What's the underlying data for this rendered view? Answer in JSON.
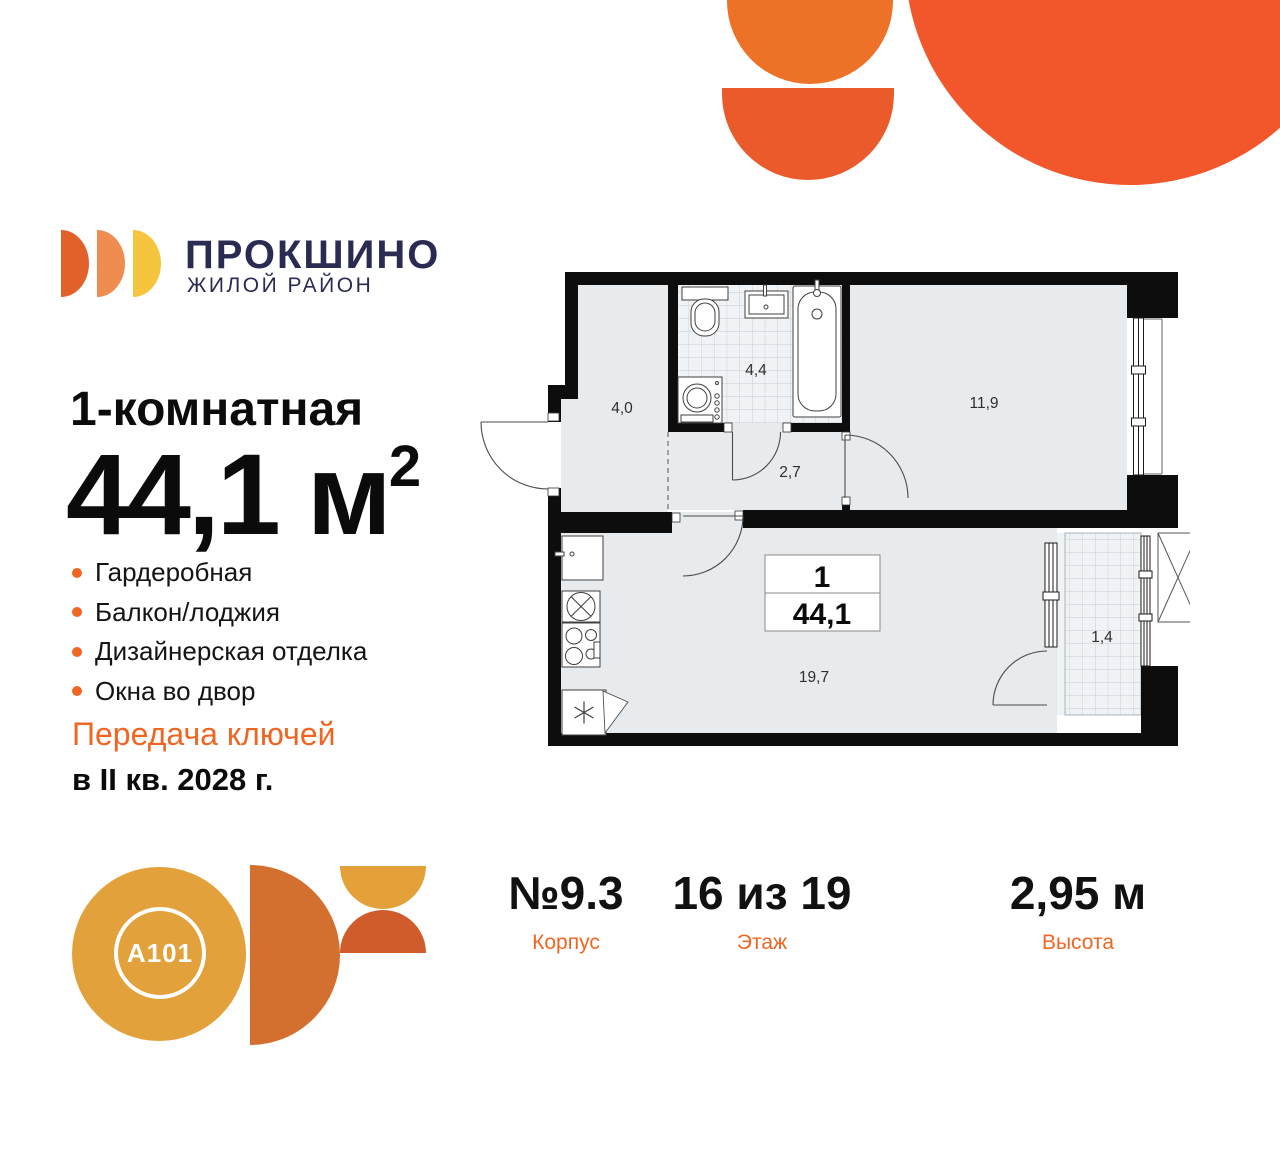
{
  "brand": {
    "name": "ПРОКШИНО",
    "tagline": "ЖИЛОЙ РАЙОН",
    "developer": "A101"
  },
  "listing": {
    "type": "1-комнатная",
    "area": "44,1",
    "area_unit": "м",
    "area_exponent": "2"
  },
  "features": [
    "Гардеробная",
    "Балкон/лоджия",
    "Дизайнерская отделка",
    "Окна во двор"
  ],
  "handover": {
    "line1": "Передача ключей",
    "line2": "в II кв. 2028 г."
  },
  "stats": [
    {
      "value": "№9.3",
      "label": "Корпус"
    },
    {
      "value": "16 из 19",
      "label": "Этаж"
    },
    {
      "value": "2,95 м",
      "label": "Высота"
    }
  ],
  "plan": {
    "info_box": {
      "rooms": "1",
      "area": "44,1"
    },
    "rooms": [
      {
        "name": "hallway",
        "area": "4,0"
      },
      {
        "name": "bathroom",
        "area": "4,4"
      },
      {
        "name": "corridor",
        "area": "2,7"
      },
      {
        "name": "bedroom",
        "area": "11,9"
      },
      {
        "name": "kitchen-living",
        "area": "19,7"
      },
      {
        "name": "balcony",
        "area": "1,4"
      }
    ]
  },
  "colors": {
    "accent_orange": "#F16522",
    "navy": "#2A2B52",
    "decor_orange_light": "#EE7128",
    "decor_orange": "#EB5A2A",
    "decor_orange_big": "#F2562B",
    "logo_d1": "#E2612B",
    "logo_d2": "#EF8C4F",
    "logo_d3": "#F6C53F",
    "a101_gold": "#E2A13B",
    "a101_rust": "#D4702F",
    "wall_black": "#0d0d0d",
    "room_fill": "#E8EBEE"
  }
}
